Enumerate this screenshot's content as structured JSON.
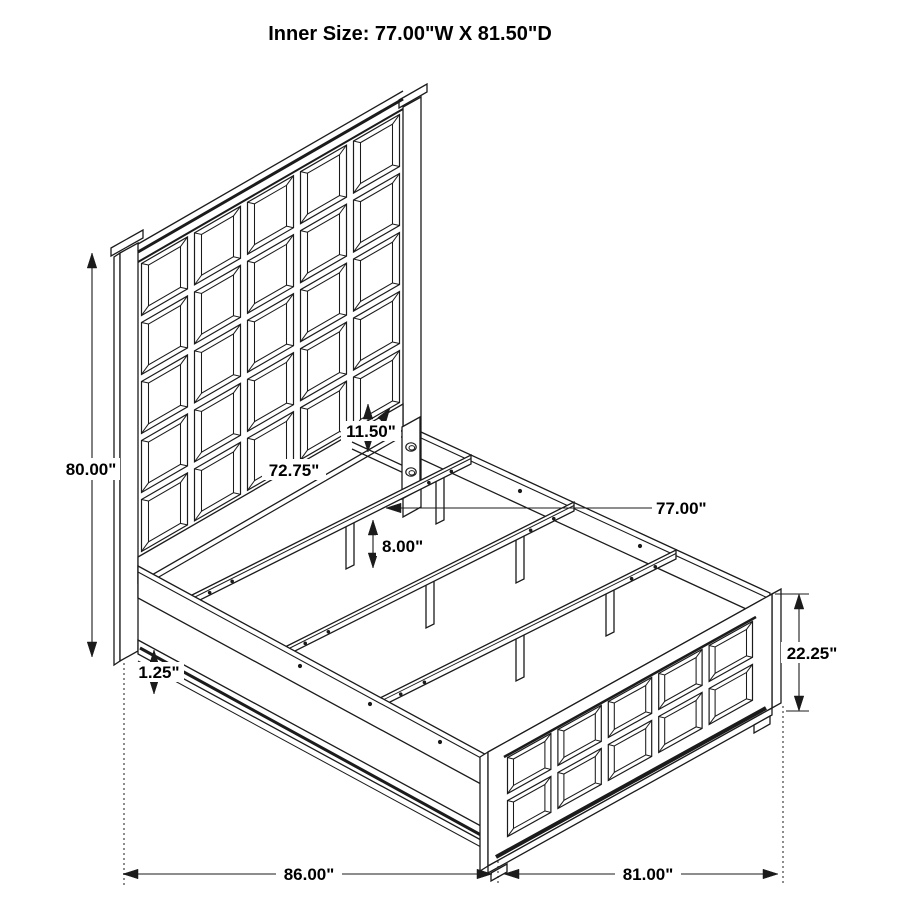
{
  "title": "Inner Size: 77.00\"W X 81.50\"D",
  "dimensions": {
    "headboard_height": "80.00\"",
    "headboard_width": "72.75\"",
    "panel_to_rail_gap": "11.50\"",
    "inner_width": "77.00\"",
    "slat_leg_height": "8.00\"",
    "base_trim_thickness": "1.25\"",
    "footboard_height": "22.25\"",
    "overall_length": "86.00\"",
    "overall_width": "81.00\""
  },
  "structure": {
    "headboard_grid": {
      "rows": 5,
      "cols": 5
    },
    "footboard_grid": {
      "rows": 2,
      "cols": 5
    },
    "slat_count": 3,
    "legs_per_slat": 2,
    "bracket_hole_count": 2
  },
  "colors": {
    "line": "#1b1b1b",
    "background": "#ffffff",
    "text": "#000000"
  }
}
